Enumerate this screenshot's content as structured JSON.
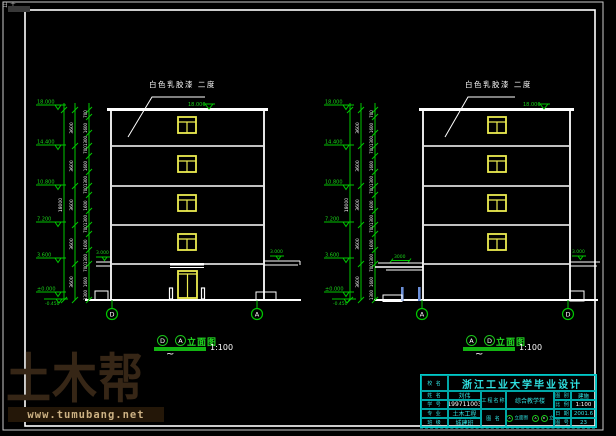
{
  "corner_mark": "日土",
  "paint_note": "白色乳胶漆 二度",
  "levels": [
    "18.000",
    "14.400",
    "10.800",
    "7.200",
    "3.600",
    "±0.000",
    "-0.450"
  ],
  "dims": {
    "total": "18000",
    "floor": "3600",
    "detail": [
      "700",
      "1600",
      "1300"
    ],
    "canopy_elev": "3.000",
    "canopy_width": "3000",
    "roof_elev": "18.000"
  },
  "elevations": [
    {
      "name": "D-A elevation",
      "grid_left": "D",
      "grid_right": "A",
      "caption_b1": "D",
      "caption_b2": "A",
      "caption_label": "立面图",
      "caption_scale": "1:100",
      "tilde": "~"
    },
    {
      "name": "A-D elevation",
      "grid_left": "A",
      "grid_right": "D",
      "caption_b1": "A",
      "caption_b2": "D",
      "caption_label": "立面图",
      "caption_scale": "1:100",
      "tilde": "~"
    }
  ],
  "watermark": {
    "brand": "土木帮",
    "url": "www.tumubang.net"
  },
  "titleblock": {
    "school_label": "校 名",
    "title": "浙江工业大学毕业设计",
    "left_rows": [
      {
        "label": "姓 名",
        "value": "刘伟"
      },
      {
        "label": "学 号",
        "value": "199711003"
      },
      {
        "label": "专 业",
        "value": "土木工程"
      },
      {
        "label": "班 级",
        "value": "城建班"
      }
    ],
    "project_label": "工程名称",
    "project_value": "综合教学楼",
    "drawing_label": "图 名",
    "drawing_parts": [
      {
        "b1": "D",
        "b2": "A",
        "t": "立面图"
      },
      {
        "b1": "A",
        "b2": "D",
        "t": "立面图"
      }
    ],
    "right_rows": [
      {
        "label": "图 别",
        "value": "建施"
      },
      {
        "label": "比 例",
        "value": "1:100"
      },
      {
        "label": "日 期",
        "value": "2001.6"
      },
      {
        "label": "图 号",
        "value": "23"
      }
    ]
  },
  "colors": {
    "line_white": "#ffffff",
    "cad_green": "#00c800",
    "level_text_green": "#19d219",
    "cad_yellow": "#ecec50",
    "titleblock_cyan": "#00d9d9",
    "post_blue": "#6b8fd8",
    "watermark_brown": "#362616",
    "watermark_band": "#241708",
    "watermark_text": "#ccb183"
  }
}
